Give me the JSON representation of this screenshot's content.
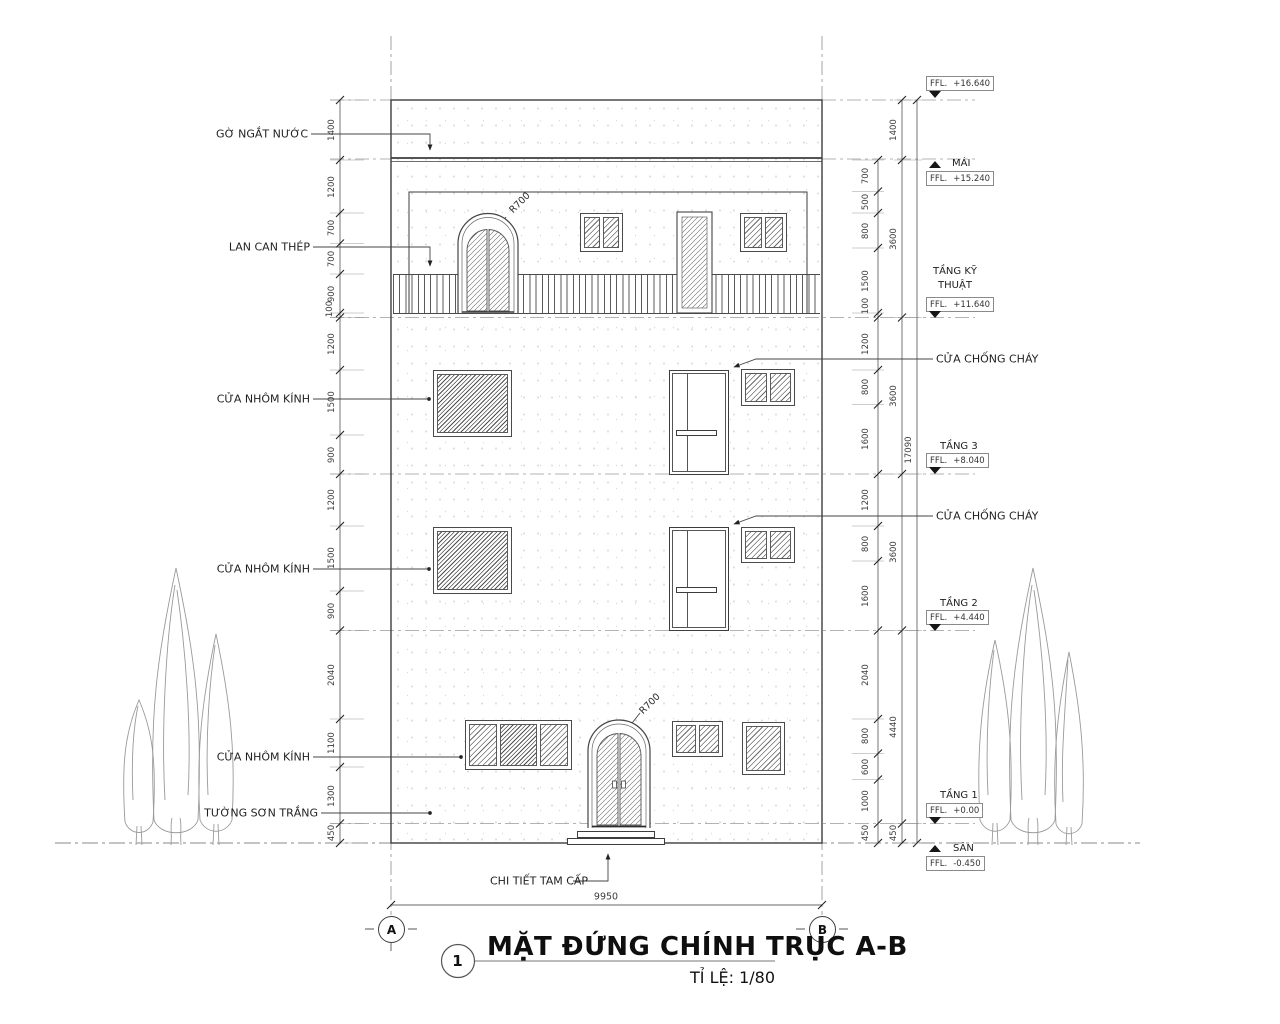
{
  "title": {
    "number": "1",
    "text": "MẶT ĐỨNG CHÍNH TRỤC A-B",
    "scale": "TỈ LỆ: 1/80"
  },
  "grid": {
    "a": "A",
    "b": "B",
    "width": "9950",
    "overall_height": "17090"
  },
  "labels": {
    "ffl": "FFL.",
    "go_ngat_nuoc": "GỜ NGẮT NƯỚC",
    "lan_can_thep": "LAN CAN THÉP",
    "cua_nhom_kinh": "CỬA NHÔM KÍNH",
    "tuong_son_trang": "TƯỜNG SƠN TRẮNG",
    "chi_tiet_tam_cap": "CHI TIẾT TAM CẤP",
    "cua_chong_chay": "CỬA CHỐNG CHÁY",
    "r700": "R700"
  },
  "levels": [
    {
      "name": "",
      "value": "+16.640"
    },
    {
      "name": "MÁI",
      "value": "+15.240"
    },
    {
      "name": "TẦNG KỸ THUẬT",
      "value": "+11.640"
    },
    {
      "name": "TẦNG 3",
      "value": "+8.040"
    },
    {
      "name": "TẦNG 2",
      "value": "+4.440"
    },
    {
      "name": "TẦNG 1",
      "value": "+0.00"
    },
    {
      "name": "SÂN",
      "value": "-0.450"
    }
  ],
  "dims": {
    "left": [
      "1400",
      "1200",
      "700",
      "700",
      "900",
      "100",
      "1200",
      "1500",
      "900",
      "1200",
      "1500",
      "900",
      "2040",
      "1100",
      "1300",
      "450"
    ],
    "right_inner": [
      "700",
      "500",
      "800",
      "1500",
      "100",
      "1200",
      "800",
      "1600",
      "1200",
      "800",
      "1600",
      "2040",
      "800",
      "600",
      "1000",
      "450"
    ],
    "right_outer": [
      "1400",
      "3600",
      "3600",
      "3600",
      "4440",
      "450"
    ]
  }
}
